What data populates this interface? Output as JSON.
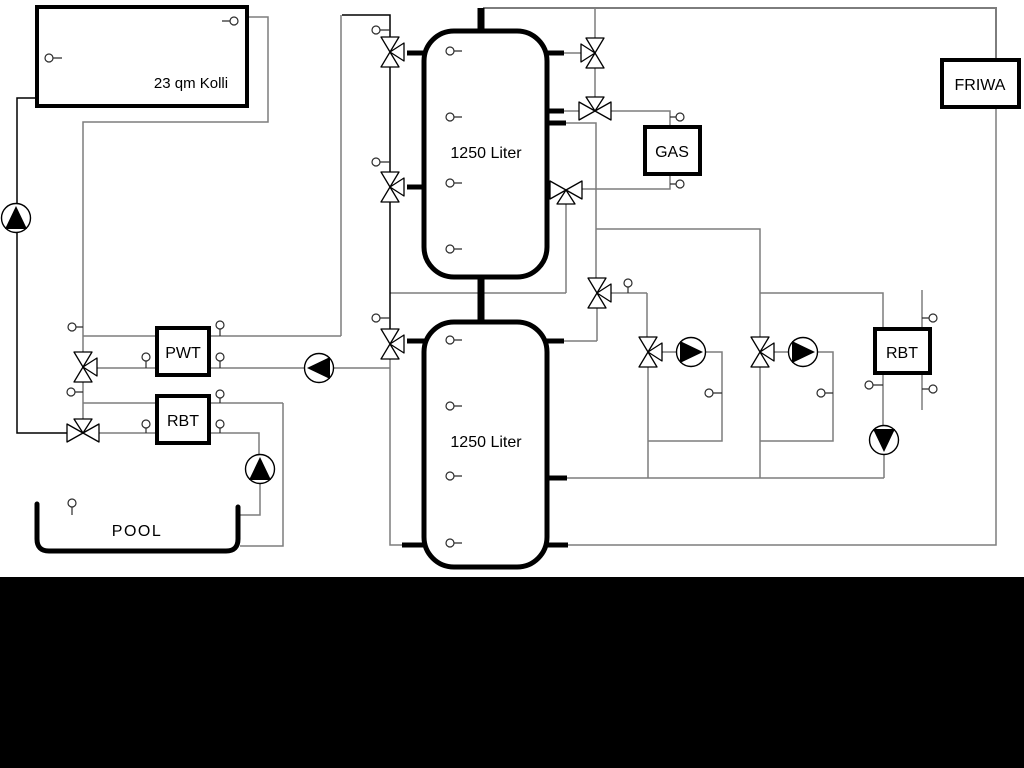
{
  "colors": {
    "background": "#ffffff",
    "pipe_gray": "#7d7d7d",
    "line_black": "#000000",
    "component_stroke": "#000000",
    "bottom_bar": "#000000",
    "symbol_fill": "#ffffff"
  },
  "icons": {
    "pump": "circle-with-filled-triangle",
    "three_way_valve": "three-triangle-bowtie",
    "sensor": "small-circle-with-stem"
  },
  "labels": {
    "collector": "23 qm Kolli",
    "tank_top": "1250 Liter",
    "tank_bottom": "1250 Liter",
    "heat_exchanger_pwt": "PWT",
    "return_unit_left": "RBT",
    "return_unit_right": "RBT",
    "boiler": "GAS",
    "fresh_water_station": "FRIWA",
    "pool": "POOL"
  }
}
